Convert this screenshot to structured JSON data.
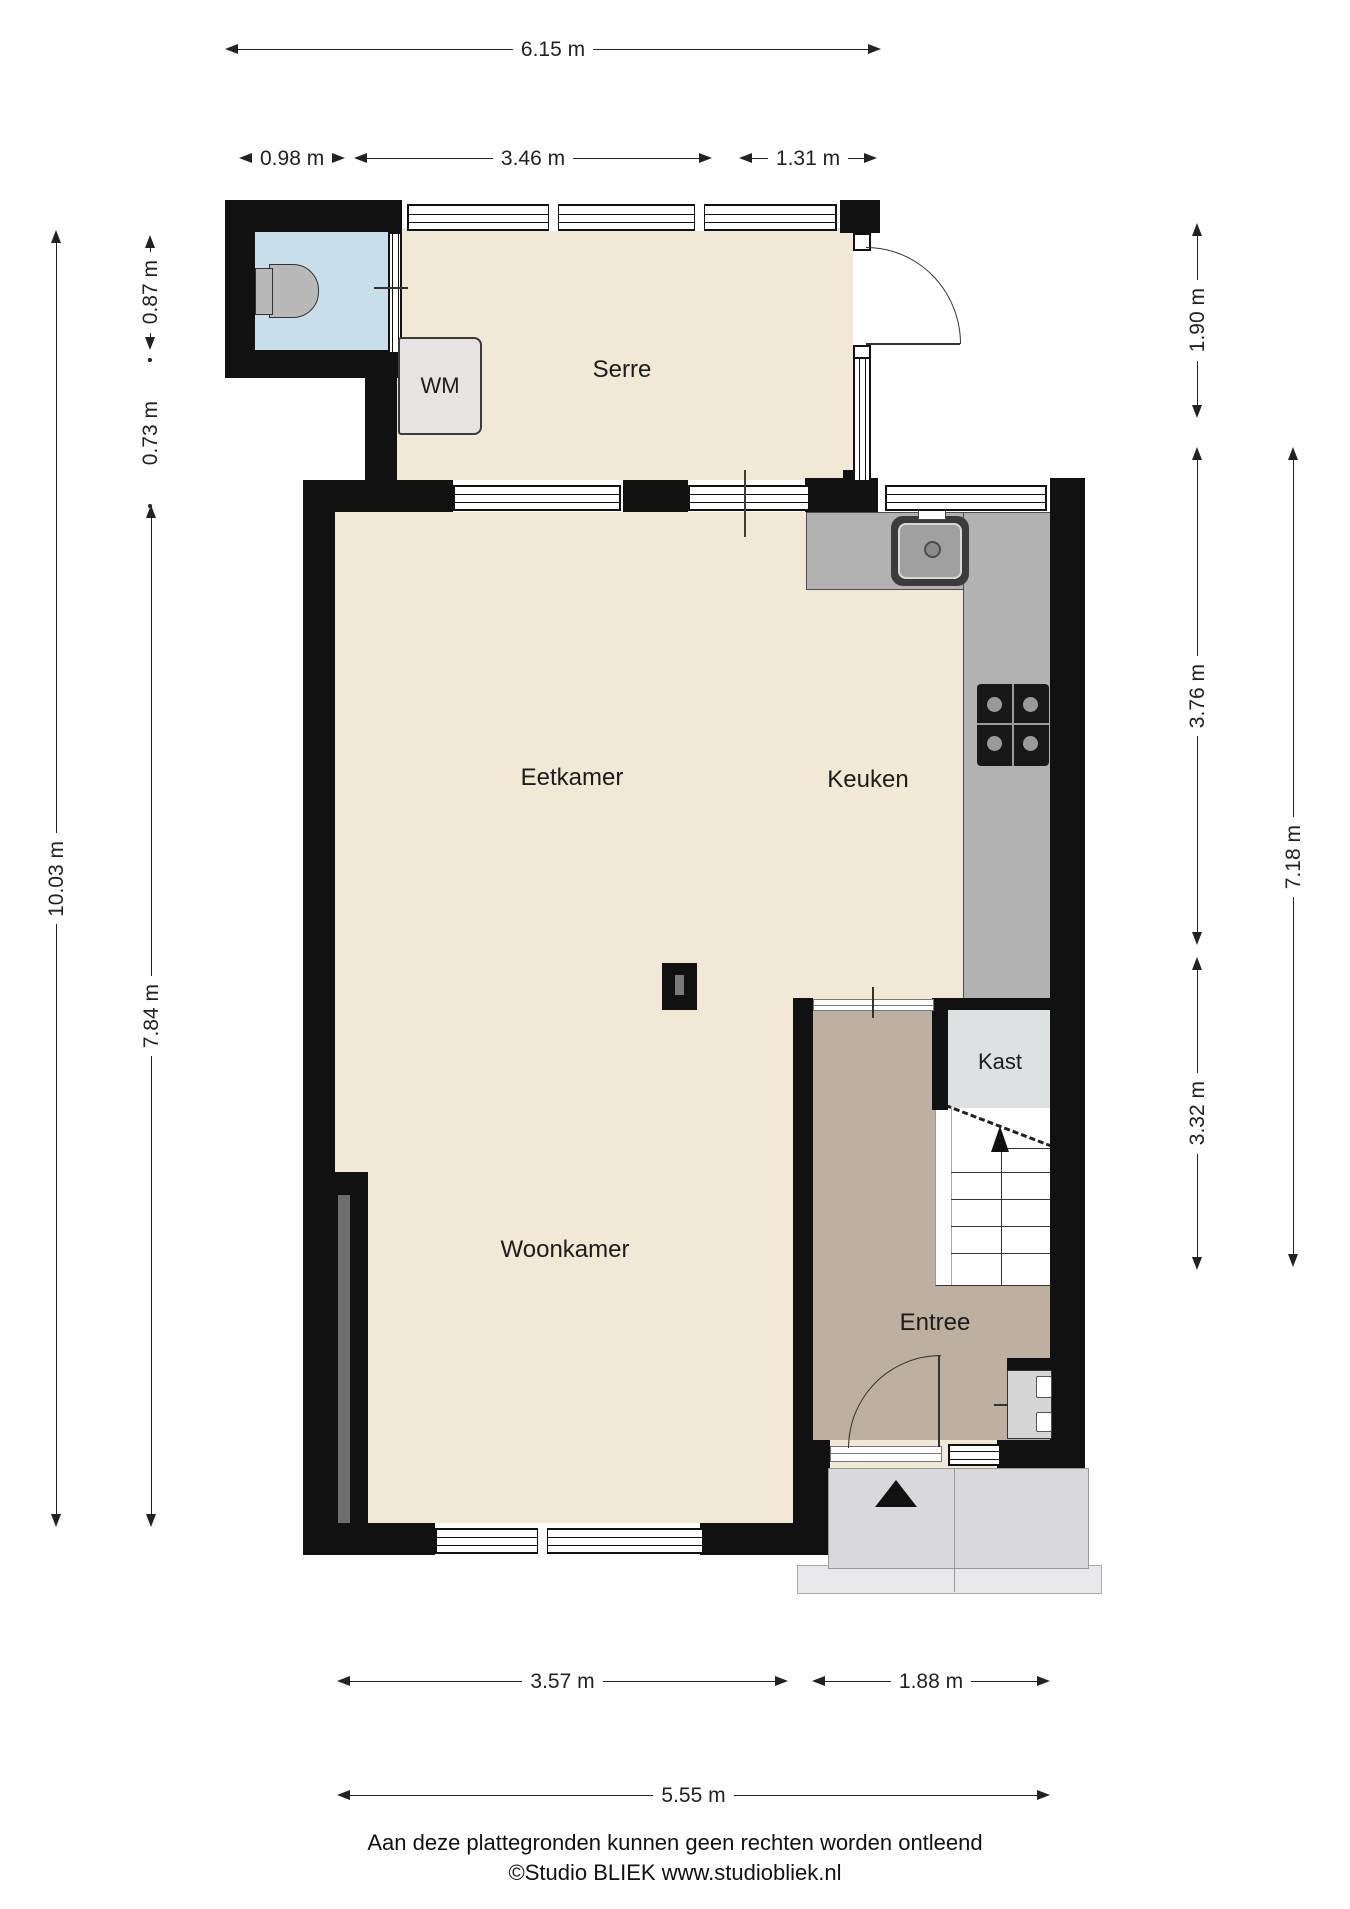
{
  "title": "Plattegrond begane grond",
  "rooms": {
    "serre": "Serre",
    "eetkamer": "Eetkamer",
    "keuken": "Keuken",
    "woonkamer": "Woonkamer",
    "kast": "Kast",
    "entree": "Entree",
    "wm": "WM"
  },
  "dimensions": {
    "top_total": "6.15 m",
    "top_left": "0.98 m",
    "top_mid": "3.46 m",
    "top_right": "1.31 m",
    "left_outer": "10.03 m",
    "left_toilet": "0.87 m",
    "left_gap": "0.73 m",
    "left_inner": "7.84 m",
    "right_serre": "1.90 m",
    "right_keuken": "3.76 m",
    "right_entree": "3.32 m",
    "right_outer": "7.18 m",
    "bottom_left": "3.57 m",
    "bottom_right": "1.88 m",
    "bottom_total": "5.55 m"
  },
  "footer": {
    "disclaimer": "Aan deze plattegronden kunnen geen rechten worden ontleend",
    "credit": "©Studio BLIEK www.studiobliek.nl"
  },
  "colors": {
    "wall": "#111111",
    "floor": "#f1e8d5",
    "hall": "#bdb0a1",
    "toilet": "#c8dfe9",
    "kast": "#dde1e2",
    "counter": "#b2b2b2",
    "step": "#d9d9db",
    "dim": "#222222"
  }
}
